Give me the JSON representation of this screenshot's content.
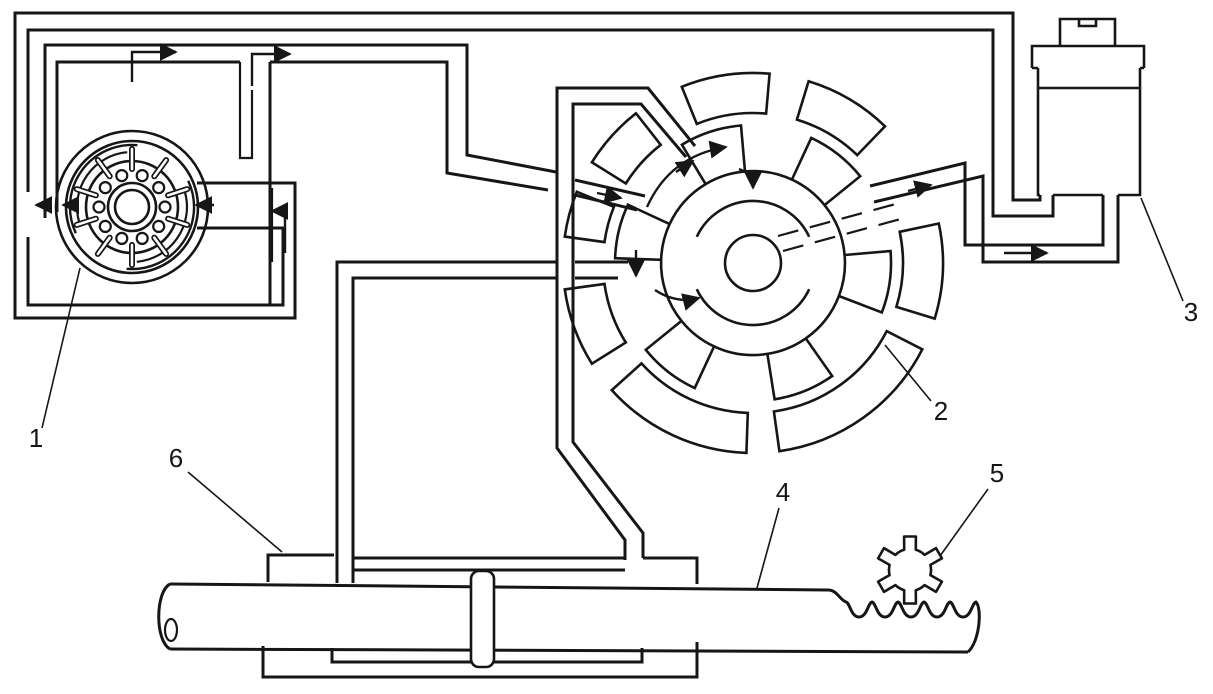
{
  "figure": {
    "background": "#ffffff",
    "ink": "#161616",
    "callouts": [
      {
        "id": "callout-1",
        "text": "1"
      },
      {
        "id": "callout-2",
        "text": "2"
      },
      {
        "id": "callout-3",
        "text": "3"
      },
      {
        "id": "callout-4",
        "text": "4"
      },
      {
        "id": "callout-5",
        "text": "5"
      },
      {
        "id": "callout-6",
        "text": "6"
      }
    ]
  }
}
